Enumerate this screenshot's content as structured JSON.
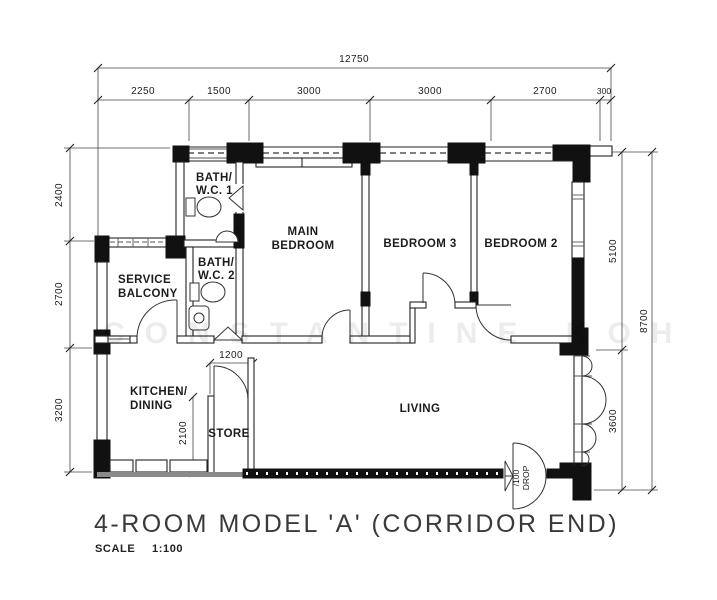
{
  "title": {
    "text": "4-ROOM MODEL 'A' (CORRIDOR END)",
    "scale_label": "SCALE",
    "scale_value": "1:100"
  },
  "watermark": "CONSTANTINE KOH",
  "rooms": {
    "bath1": [
      "BATH/",
      "W.C. 1"
    ],
    "bath2": [
      "BATH/",
      "W.C. 2"
    ],
    "main_bedroom": [
      "MAIN",
      "BEDROOM"
    ],
    "bedroom3": "BEDROOM 3",
    "bedroom2": "BEDROOM 2",
    "service_balcony": [
      "SERVICE",
      "BALCONY"
    ],
    "kitchen": [
      "KITCHEN/",
      "DINING"
    ],
    "store": "STORE",
    "living": "LIVING"
  },
  "dimensions": {
    "overall_width": "12750",
    "top_segments": [
      "2250",
      "1500",
      "3000",
      "3000",
      "2700",
      "300"
    ],
    "left_segments": [
      "2400",
      "2700",
      "3200"
    ],
    "right_segments": [
      "5100",
      "3600"
    ],
    "right_overall": "8700",
    "store_width": "1200",
    "store_depth": "2100",
    "entrance_note_line1": "/100",
    "entrance_note_line2": "DROP"
  }
}
